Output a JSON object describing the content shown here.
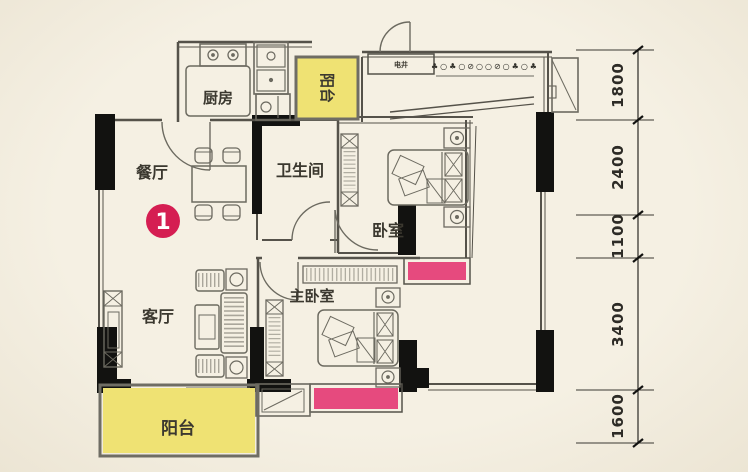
{
  "plan": {
    "title": "apartment-floor-plan",
    "badge": {
      "number": "1"
    },
    "rooms": {
      "kitchen": {
        "label": "厨房"
      },
      "dining": {
        "label": "餐厅"
      },
      "living": {
        "label": "客厅"
      },
      "bathroom": {
        "label": "卫生间"
      },
      "bedroom": {
        "label": "卧室"
      },
      "master_bedroom": {
        "label": "主卧室"
      },
      "balcony_top": {
        "label": "阳台"
      },
      "balcony_bottom": {
        "label": "阳台"
      },
      "electric_shaft": {
        "label": "电井"
      }
    },
    "decor_row": "♣○♣○⊘○○⊘○♣○♣",
    "dimensions": {
      "segments": [
        "1800",
        "2400",
        "1100",
        "3400",
        "1600"
      ]
    },
    "colors": {
      "background": "#f4efe2",
      "balcony_fill": "#efe273",
      "window_fill": "#e64a7e",
      "badge_fill": "#d51e52",
      "wall_black": "#121210",
      "line_gray": "#55524a"
    }
  }
}
